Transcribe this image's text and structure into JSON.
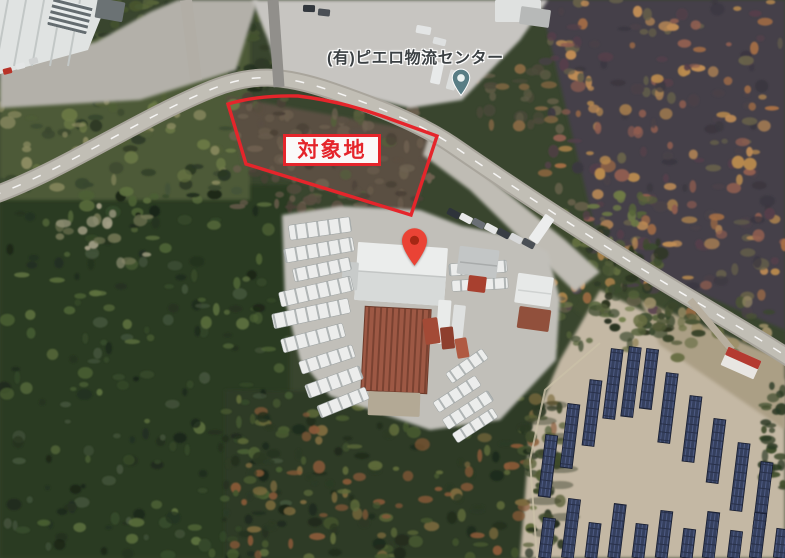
{
  "map": {
    "business_label": "(有)ピエロ物流センター",
    "annotation_label": "対象地",
    "icons": {
      "business_pin": "teal-map-pin",
      "location_pin": "red-map-pin"
    },
    "colors": {
      "annotation_red": "#e5252b",
      "pin_red": "#ea4335",
      "pin_red_dot": "#a52714",
      "pin_teal": "#587d85",
      "pin_teal_dot": "#e9f1f1",
      "label_text": "#3b4043"
    }
  }
}
